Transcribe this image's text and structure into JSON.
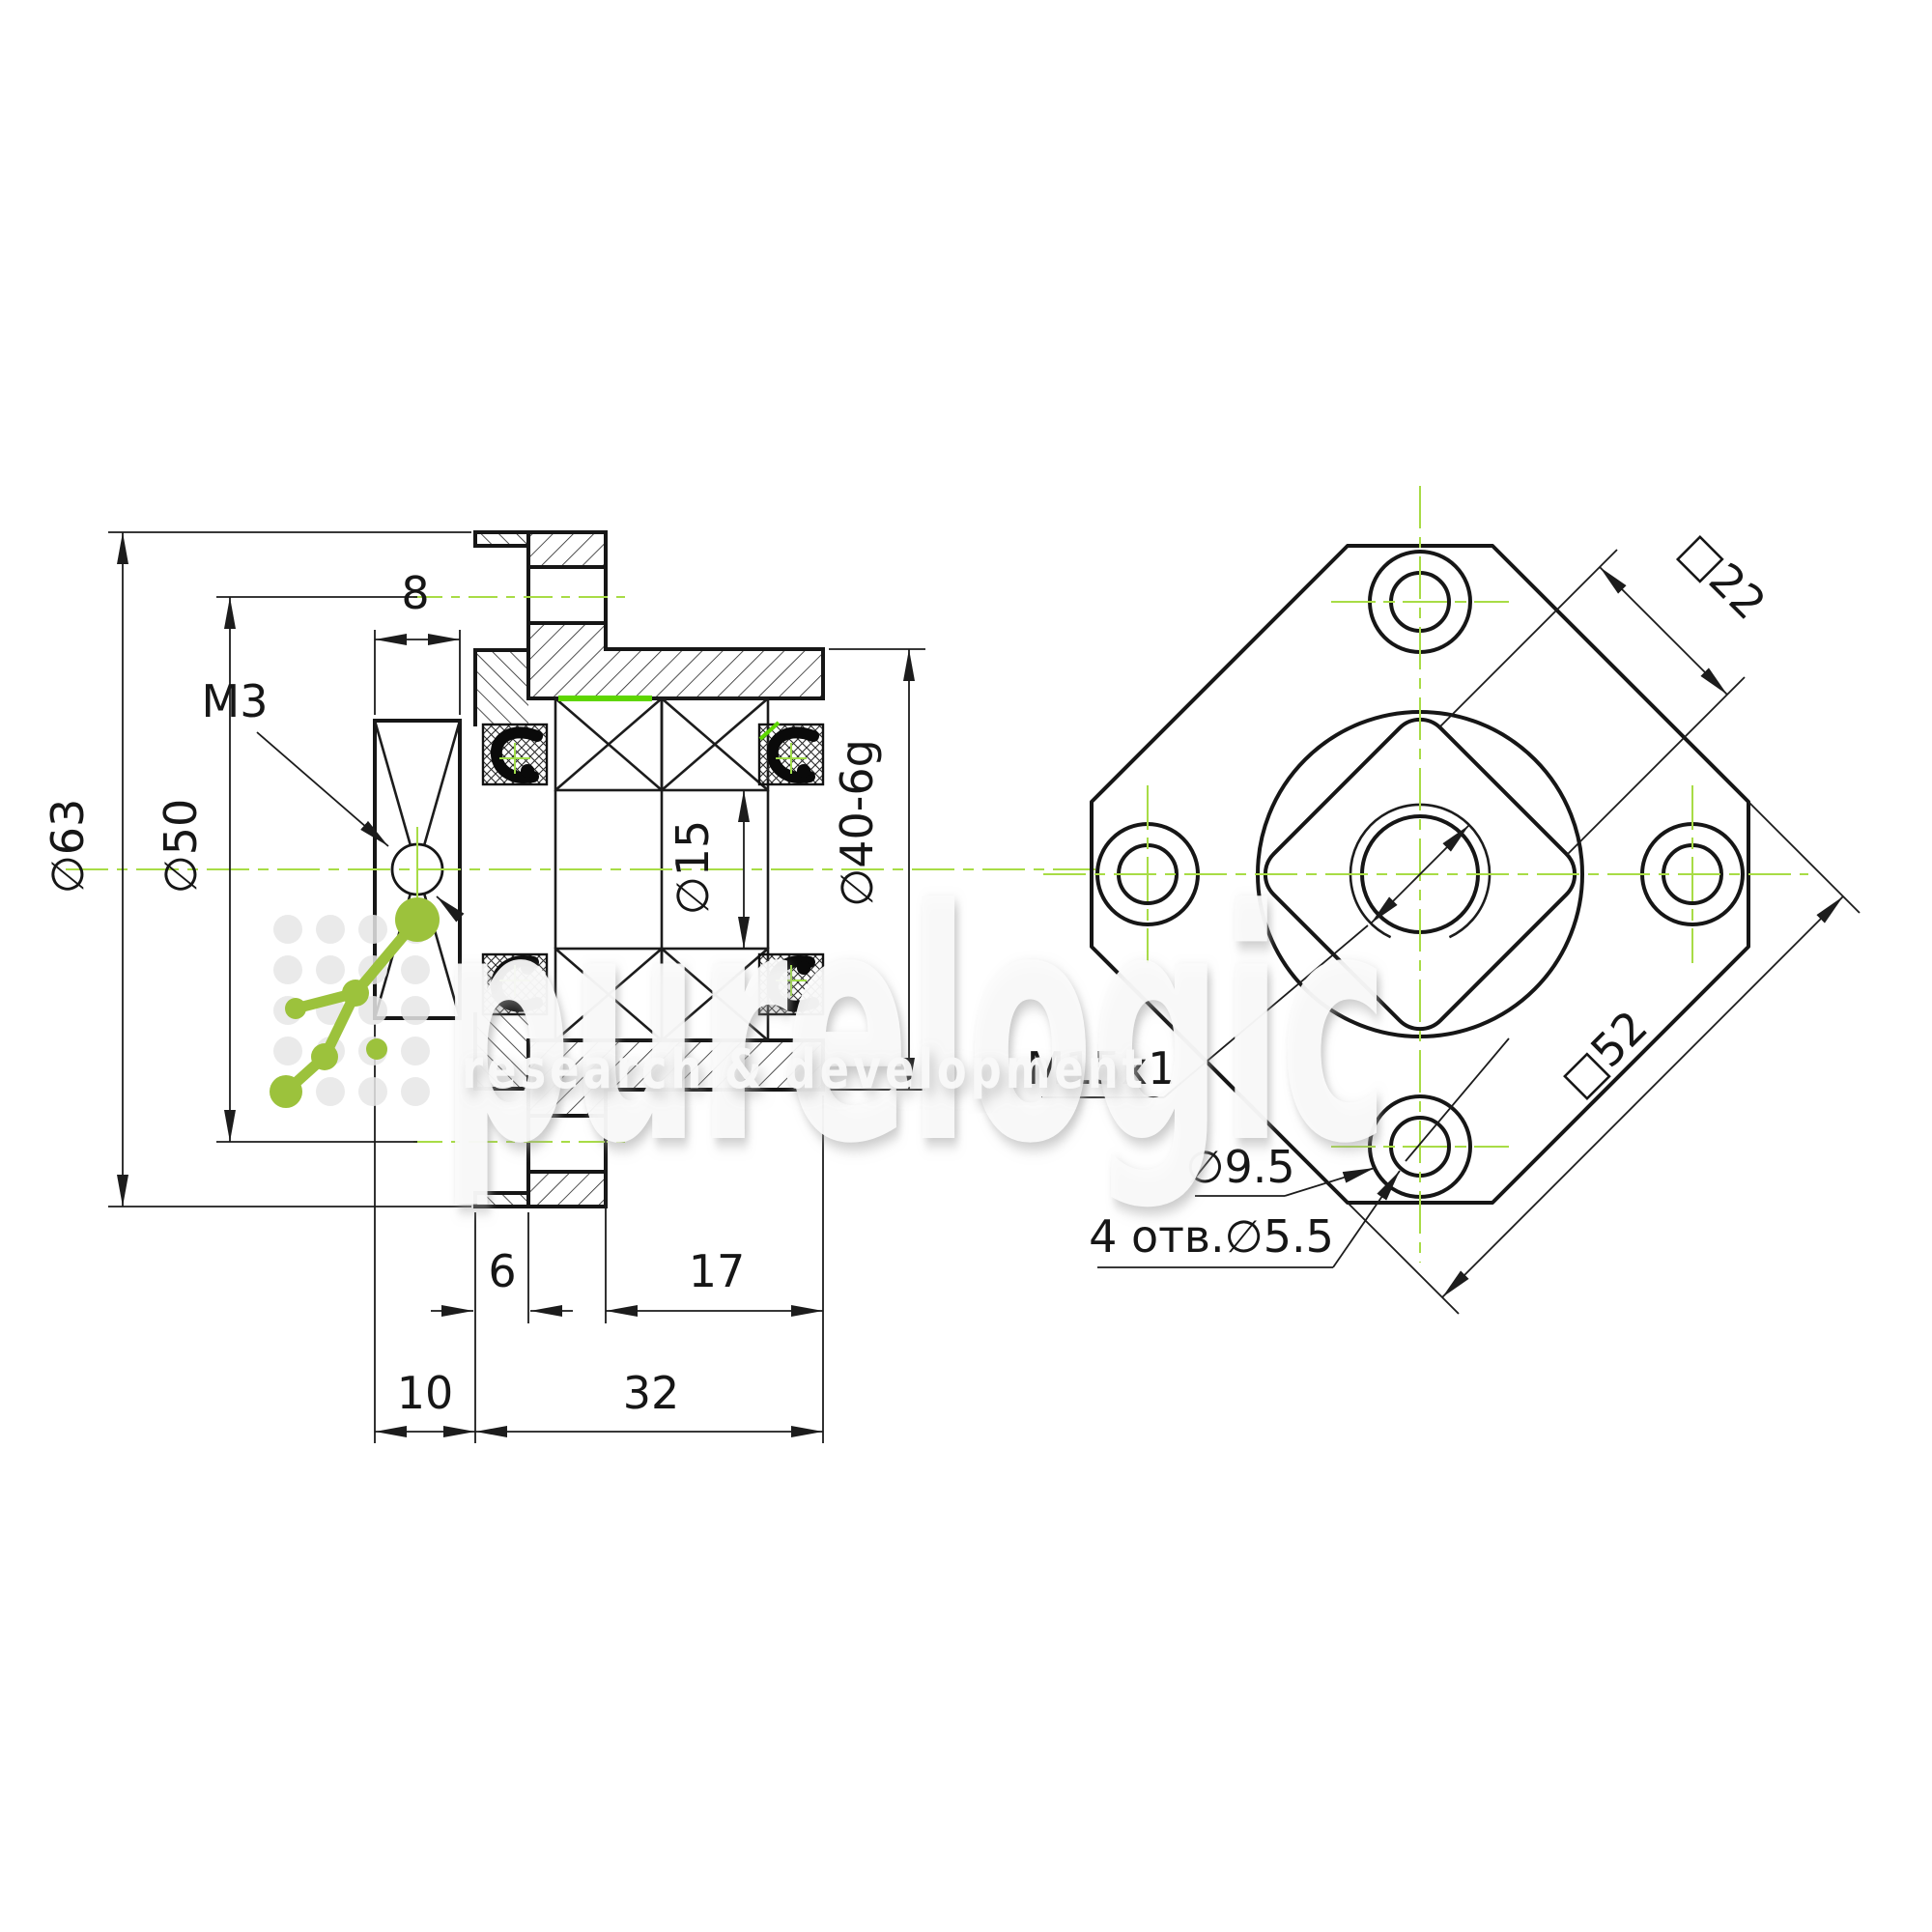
{
  "drawing_title": "flanged ballscrew support bearing unit drawing",
  "section_view": {
    "dim_flange_od": "∅63",
    "dim_bolt_circle": "∅50",
    "dim_set_screw": "M3",
    "dim_nut_width": "8",
    "dim_bore": "∅15",
    "dim_pilot_od": "∅40-6g",
    "dim_flange_thickness": "6",
    "dim_pilot_length": "17",
    "dim_nut_offset": "10",
    "dim_body_length": "32"
  },
  "front_view": {
    "dim_wrench_flats": "□22",
    "dim_flange_square": "□52",
    "dim_thread": "M15x1",
    "dim_counterbore": "∅9.5",
    "dim_bolt_holes": "4 отв.∅5.5"
  },
  "watermark": {
    "brand": "purelogic",
    "tagline": "research & development"
  },
  "colors": {
    "line": "#161616",
    "centerline_green": "#a8dc46",
    "highlight_green": "#5ed600",
    "logo_green": "#9cc23c",
    "watermark_gray": "#e7e7e7"
  }
}
